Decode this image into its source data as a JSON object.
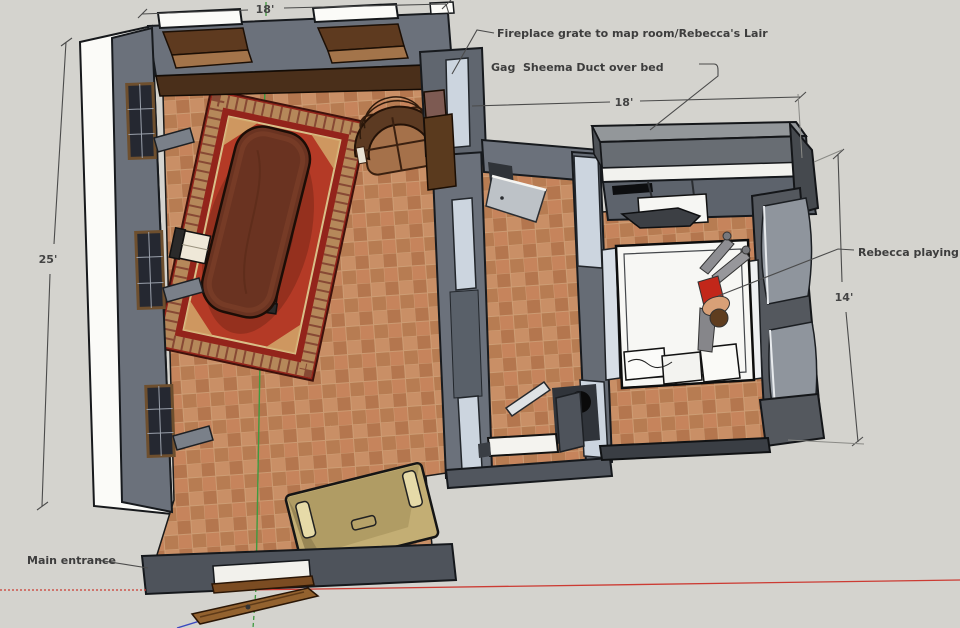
{
  "annotations": {
    "fireplace_note": "Fireplace grate to map room/Rebecca's Lair",
    "duct_note": "Gag  Sheema Duct over bed",
    "rebecca_note": "Rebecca playing",
    "entrance_note": "Main entrance"
  },
  "dimensions": {
    "main_room_width": "18'",
    "main_room_depth": "25'",
    "bedroom_width": "18'",
    "bedroom_depth": "14'"
  },
  "colors": {
    "background": "#d4d3ce",
    "floor_tile": "#c08a60",
    "wall_gray": "#6b717b",
    "dark_wall": "#54585e",
    "rug_red": "#a52e1f",
    "table_wood": "#6a3321",
    "axis_red": "#cc3b33",
    "axis_green": "#3f9a3f",
    "axis_blue": "#3a49c0",
    "annotation_text": "#3d3d3d"
  }
}
